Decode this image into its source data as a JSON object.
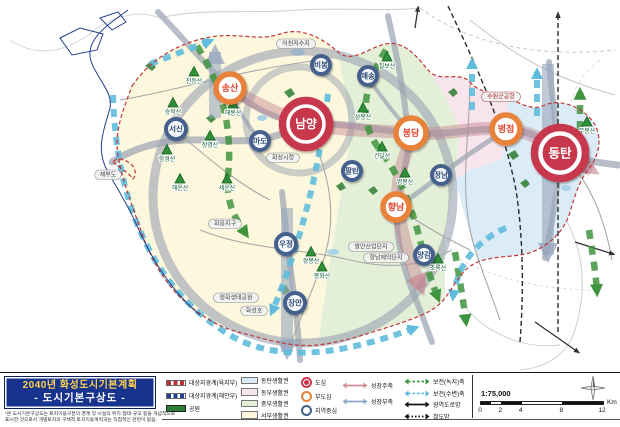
{
  "title_block": {
    "line1": "2040년 화성도시기본계획",
    "line2": "- 도시기본구상도 -",
    "disclaimer1": "*본 도시기본구상도는 토지이용구분의 경계 및 시설의 위치·형태·규모 등을 개념적으로",
    "disclaimer2": "표시한 것으로서 개별토지의 구체적 토지이용계획과는 직접적인 관련이 없음."
  },
  "legend": {
    "boundaries": [
      {
        "label": "대상지경계(육지부)",
        "color": "#c03030",
        "style": "dash"
      },
      {
        "label": "대상지경계(해안부)",
        "color": "#27408f",
        "style": "dash"
      },
      {
        "label": "공원",
        "color": "#2e7d32",
        "style": "park"
      }
    ],
    "zones": [
      {
        "label": "동탄생활권",
        "color": "#dcecf6"
      },
      {
        "label": "동부생활권",
        "color": "#f7e4ec"
      },
      {
        "label": "중부생활권",
        "color": "#e3f0d7"
      },
      {
        "label": "서부생활권",
        "color": "#fdf8dd"
      }
    ],
    "centers": [
      {
        "label": "도심",
        "type": "dosim"
      },
      {
        "label": "부도심",
        "type": "budosim"
      },
      {
        "label": "지역중심",
        "type": "jiyeok"
      }
    ],
    "axes1": [
      {
        "label": "성장주축",
        "color": "#cf8b96"
      },
      {
        "label": "성장부축",
        "color": "#8fa9cd"
      }
    ],
    "axes2": [
      {
        "label": "보전(녹지)축",
        "color": "#3f9440",
        "style": "green-dash"
      },
      {
        "label": "보전(수변)축",
        "color": "#5fbcdc",
        "style": "cyan-dash"
      },
      {
        "label": "광역도로망",
        "color": "#111111",
        "style": "black-solid"
      },
      {
        "label": "철도망",
        "color": "#111111",
        "style": "black-dot"
      }
    ],
    "scale": {
      "ratio": "1:75,000",
      "ticks": [
        "0",
        "2",
        "4",
        "8",
        "12"
      ],
      "unit": "Km"
    }
  },
  "map": {
    "nodes": [
      {
        "type": "dosim",
        "label": "남양",
        "x": 306,
        "y": 124,
        "r": 28
      },
      {
        "type": "dosim",
        "label": "동탄",
        "x": 560,
        "y": 153,
        "r": 30
      },
      {
        "type": "budosim",
        "label": "송산",
        "x": 230,
        "y": 88,
        "r": 17
      },
      {
        "type": "budosim",
        "label": "봉담",
        "x": 411,
        "y": 133,
        "r": 18
      },
      {
        "type": "budosim",
        "label": "병점",
        "x": 506,
        "y": 129,
        "r": 17
      },
      {
        "type": "budosim",
        "label": "향남",
        "x": 396,
        "y": 207,
        "r": 16
      },
      {
        "type": "jiyeok",
        "label": "서신",
        "x": 176,
        "y": 129,
        "r": 12
      },
      {
        "type": "jiyeok",
        "label": "마도",
        "x": 260,
        "y": 141,
        "r": 11
      },
      {
        "type": "jiyeok",
        "label": "비봉",
        "x": 321,
        "y": 65,
        "r": 11
      },
      {
        "type": "jiyeok",
        "label": "매송",
        "x": 368,
        "y": 76,
        "r": 11
      },
      {
        "type": "jiyeok",
        "label": "팔탄",
        "x": 352,
        "y": 171,
        "r": 11
      },
      {
        "type": "jiyeok",
        "label": "정남",
        "x": 441,
        "y": 175,
        "r": 11
      },
      {
        "type": "jiyeok",
        "label": "양감",
        "x": 424,
        "y": 255,
        "r": 11
      },
      {
        "type": "jiyeok",
        "label": "우정",
        "x": 286,
        "y": 244,
        "r": 12
      },
      {
        "type": "jiyeok",
        "label": "장안",
        "x": 295,
        "y": 303,
        "r": 12
      }
    ],
    "mountains": [
      {
        "label": "천등산",
        "x": 194,
        "y": 72
      },
      {
        "label": "승학산",
        "x": 173,
        "y": 103
      },
      {
        "label": "해봉산",
        "x": 233,
        "y": 104
      },
      {
        "label": "청명산",
        "x": 210,
        "y": 136
      },
      {
        "label": "함경산",
        "x": 167,
        "y": 150
      },
      {
        "label": "해운산",
        "x": 180,
        "y": 179
      },
      {
        "label": "세운산",
        "x": 227,
        "y": 179
      },
      {
        "label": "칠보산",
        "x": 387,
        "y": 57
      },
      {
        "label": "삼봉산",
        "x": 363,
        "y": 108
      },
      {
        "label": "건달산",
        "x": 382,
        "y": 147
      },
      {
        "label": "명봉산",
        "x": 405,
        "y": 173
      },
      {
        "label": "무봉산",
        "x": 587,
        "y": 122
      },
      {
        "label": "쌍봉산",
        "x": 311,
        "y": 252
      },
      {
        "label": "봉화산",
        "x": 322,
        "y": 267
      },
      {
        "label": "초록산",
        "x": 438,
        "y": 259
      }
    ],
    "labels": [
      {
        "label": "어천저수지",
        "x": 296,
        "y": 44
      },
      {
        "label": "수원군공항",
        "x": 501,
        "y": 97,
        "accent": true
      },
      {
        "label": "화성시청",
        "x": 283,
        "y": 158
      },
      {
        "label": "제부도",
        "x": 108,
        "y": 175
      },
      {
        "label": "화옹지구",
        "x": 225,
        "y": 224
      },
      {
        "label": "평화생태공원",
        "x": 236,
        "y": 298
      },
      {
        "label": "화성호",
        "x": 254,
        "y": 311
      },
      {
        "label": "발안산업단지",
        "x": 371,
        "y": 247
      },
      {
        "label": "향남제약단지",
        "x": 386,
        "y": 258
      }
    ]
  },
  "colors": {
    "dosim": "#c8374e",
    "budosim": "#e8823a",
    "budosim_text": "#e0452e",
    "jiyeok": "#44608c",
    "jiyeok_text": "#2d4a74",
    "axis_pink": "#c2808d",
    "axis_grayblue": "#97a6bd",
    "axis_green": "#3f9440",
    "axis_cyan": "#5fbcdc",
    "park": "#2e7d32",
    "boundary_red": "#c03636",
    "boundary_blue": "#27408f"
  }
}
